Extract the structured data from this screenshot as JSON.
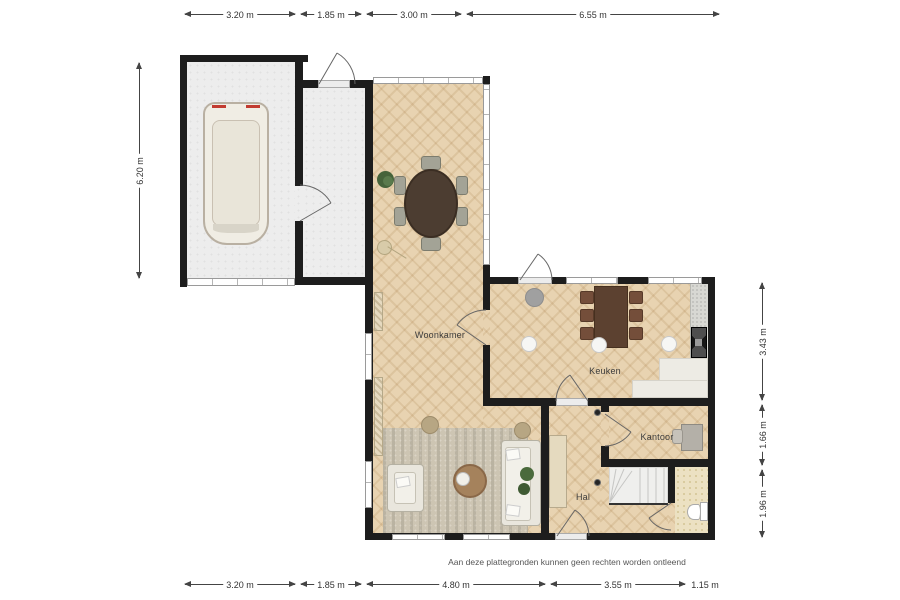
{
  "rooms": {
    "living": "Woonkamer",
    "kitchen": "Keuken",
    "office": "Kantoor",
    "hall": "Hal"
  },
  "disclaimer": "Aan deze plattegronden kunnen geen rechten worden ontleend",
  "dimensions": {
    "top": [
      {
        "label": "3.20 m"
      },
      {
        "label": "1.85 m"
      },
      {
        "label": "3.00 m"
      },
      {
        "label": "6.55 m"
      }
    ],
    "bottom": [
      {
        "label": "3.20 m"
      },
      {
        "label": "1.85 m"
      },
      {
        "label": "4.80 m"
      },
      {
        "label": "3.55 m"
      },
      {
        "label": "1.15 m"
      }
    ],
    "left": [
      {
        "label": "6.20 m"
      }
    ],
    "right": [
      {
        "label": "3.43 m"
      },
      {
        "label": "1.66 m"
      },
      {
        "label": "1.96 m"
      }
    ]
  },
  "colors": {
    "wall": "#1d1d1d",
    "dimLine": "#444444",
    "dimText": "#333333",
    "labelText": "#3b3b3b",
    "woodBase": "#e8d3b1",
    "hardFloor": "#ededed",
    "tileFloor": "#ece1c2",
    "tileDot": "#d9cb9f",
    "rug": "#cdc5b3",
    "upholstery": "#e9e6dd",
    "upholsteryLine": "#b5b1a3",
    "diningTable": "#4c3d31",
    "kitchenTable": "#5c4130",
    "kitchenChair": "#744e3a",
    "diningChair": "#a3a396",
    "counter": "#d8d8d3",
    "counterLight": "#edebe4",
    "cabinet": "#e5dabf",
    "coffeeTable": "#a5825c",
    "pouf": "#b7a683",
    "plantGreen": "#4a6a3c",
    "stairs": "#efefed",
    "doorStroke": "#666666",
    "vanBody": "#f0ede4"
  }
}
